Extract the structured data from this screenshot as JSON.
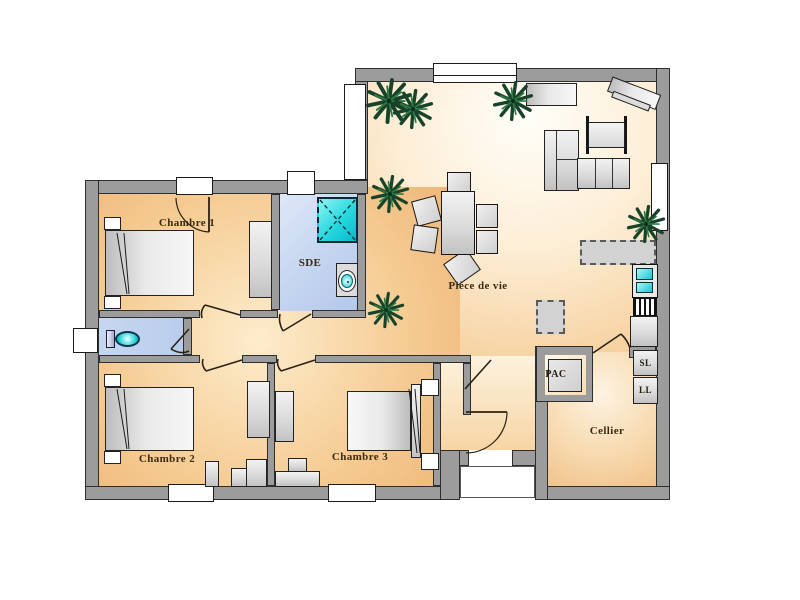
{
  "plan": {
    "rooms": {
      "chambre1": "Chambre 1",
      "chambre2": "Chambre 2",
      "chambre3": "Chambre 3",
      "sde": "SDE",
      "piece_de_vie": "Pièce de vie",
      "cellier": "Cellier"
    },
    "equipment": {
      "pac": "PAC",
      "sl": "SL",
      "ll": "LL"
    },
    "colors": {
      "wall": "#9c9c9c",
      "floor_warm_light": "#fdf4e4",
      "floor_warm": "#efb878",
      "floor_wet": "#c2d3ef",
      "shower_cyan": "#17d8e0",
      "plant_green": "#17432a",
      "label_brown": "#3b2a10"
    },
    "icons": {
      "plant": "plant-icon",
      "shower": "shower-icon",
      "sink": "sink-icon",
      "toilet": "toilet-icon"
    }
  }
}
